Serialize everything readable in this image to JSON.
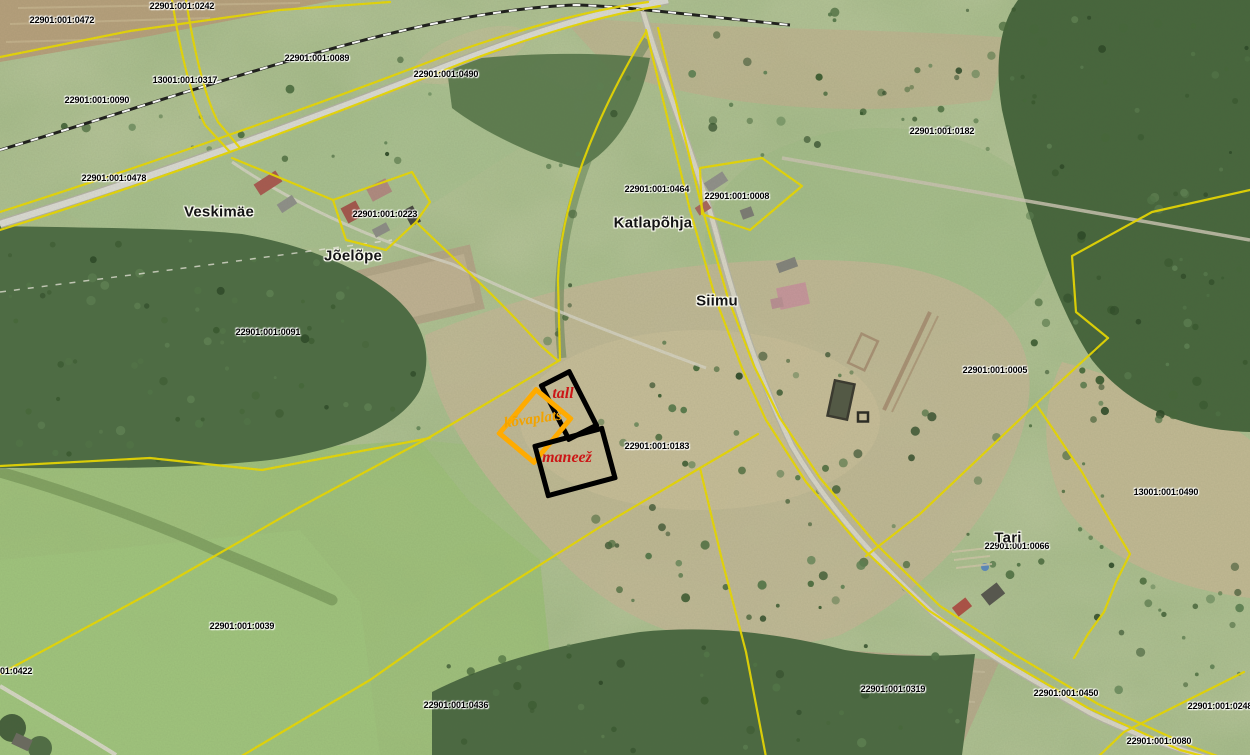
{
  "map": {
    "kind": "cadastral-aerial-map",
    "colors": {
      "cadastral_line": "#EAD902",
      "annotation_black": "#000000",
      "annotation_orange": "#FFAB00",
      "annotation_red": "#CC1616",
      "parcel_label": "#000000",
      "place_label": "#141414"
    },
    "place_labels": [
      {
        "text": "Veskimäe",
        "x": 219,
        "y": 212
      },
      {
        "text": "Jõelõpe",
        "x": 353,
        "y": 256
      },
      {
        "text": "Katlapõhja",
        "x": 653,
        "y": 223
      },
      {
        "text": "Siimu",
        "x": 717,
        "y": 301
      },
      {
        "text": "Tari",
        "x": 1008,
        "y": 538
      }
    ],
    "parcel_labels": [
      {
        "text": "22901:001:0472",
        "x": 62,
        "y": 20
      },
      {
        "text": "22901:001:0242",
        "x": 182,
        "y": 6
      },
      {
        "text": "13001:001:0317",
        "x": 185,
        "y": 80
      },
      {
        "text": "22901:001:0090",
        "x": 97,
        "y": 100
      },
      {
        "text": "22901:001:0089",
        "x": 317,
        "y": 58
      },
      {
        "text": "22901:001:0490",
        "x": 446,
        "y": 74
      },
      {
        "text": "22901:001:0478",
        "x": 114,
        "y": 178
      },
      {
        "text": "22901:001:0223",
        "x": 385,
        "y": 214
      },
      {
        "text": "22901:001:0464",
        "x": 657,
        "y": 189
      },
      {
        "text": "22901:001:0008",
        "x": 737,
        "y": 196
      },
      {
        "text": "22901:001:0182",
        "x": 942,
        "y": 131
      },
      {
        "text": "22901:001:0091",
        "x": 268,
        "y": 332
      },
      {
        "text": "22901:001:0183",
        "x": 657,
        "y": 446
      },
      {
        "text": "22901:001:0005",
        "x": 995,
        "y": 370
      },
      {
        "text": "13001:001:0490",
        "x": 1166,
        "y": 492
      },
      {
        "text": "22901:001:0066",
        "x": 1017,
        "y": 546
      },
      {
        "text": "22901:001:0039",
        "x": 242,
        "y": 626
      },
      {
        "text": "22901:001:0436",
        "x": 456,
        "y": 705
      },
      {
        "text": "22901:001:0422",
        "x": 0,
        "y": 671
      },
      {
        "text": "22901:001:0319",
        "x": 893,
        "y": 689
      },
      {
        "text": "22901:001:0450",
        "x": 1066,
        "y": 693
      },
      {
        "text": "22901:001:0248",
        "x": 1220,
        "y": 706
      },
      {
        "text": "22901:001:0080",
        "x": 1159,
        "y": 741
      }
    ],
    "annotations": [
      {
        "id": "tall",
        "label": "tall",
        "shape": {
          "x": 564,
          "y": 400,
          "w": 26,
          "h": 55,
          "rot": -27
        },
        "stroke": "#000000",
        "label_color": "#CC1616",
        "label_size": 16,
        "label_pos": {
          "x": 563,
          "y": 394,
          "rot": 0
        }
      },
      {
        "id": "kovaplats",
        "label": "kõvaplats",
        "shape": {
          "x": 530,
          "y": 421,
          "w": 40,
          "h": 52,
          "rot": 40
        },
        "stroke": "#FFAB00",
        "label_color": "#F2A300",
        "label_size": 15,
        "label_pos": {
          "x": 533,
          "y": 420,
          "rot": -8
        }
      },
      {
        "id": "maneez",
        "label": "maneež",
        "shape": {
          "x": 570,
          "y": 457,
          "w": 64,
          "h": 46,
          "rot": -15
        },
        "stroke": "#000000",
        "label_color": "#CC1616",
        "label_size": 16,
        "label_pos": {
          "x": 567,
          "y": 458,
          "rot": 0
        }
      }
    ]
  }
}
